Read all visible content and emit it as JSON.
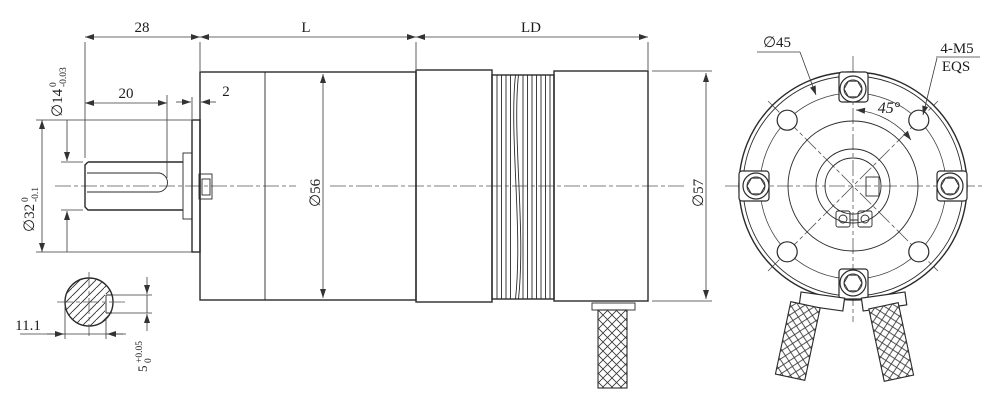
{
  "labels": {
    "top": {
      "d28": "28",
      "L": "L",
      "LD": "LD"
    },
    "side": {
      "slot_length": "20",
      "plate_thickness": "2",
      "gearbox_dia": "∅56",
      "motor_dia": "∅57",
      "shaft_dia": {
        "v": "∅14",
        "sup": "0",
        "sub": "-0.03"
      },
      "hub_dia": {
        "v": "∅32",
        "sup": "0",
        "sub": "-0.1"
      }
    },
    "section": {
      "across_flat": "11.1",
      "slot_width": {
        "v": "5",
        "sup": "+0.05",
        "sub": "0"
      }
    },
    "front": {
      "bolt_circle": "∅45",
      "thread_spec": "4-M5",
      "thread_note": "EQS",
      "angle": "45°"
    }
  },
  "colors": {
    "line": "#2a2a2a",
    "dim": "#3a3a3a",
    "background": "#ffffff"
  }
}
